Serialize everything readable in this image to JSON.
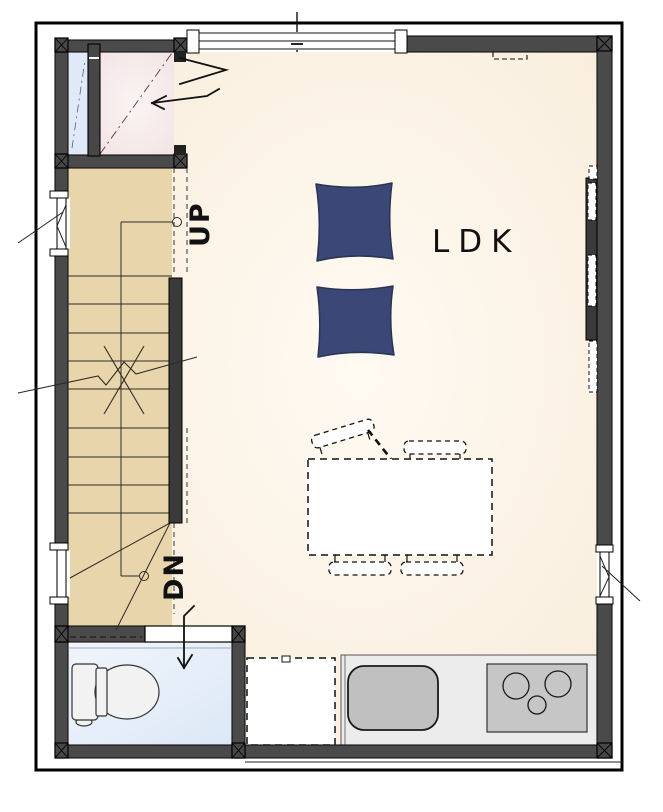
{
  "floor_plan": {
    "room_label": "LDK",
    "stairs": {
      "up_label": "UP",
      "dn_label": "DN"
    },
    "rooms": [
      {
        "name": "living-dining-kitchen",
        "label": "LDK",
        "floor_color": "#fbf1e1"
      },
      {
        "name": "staircase",
        "floor_color": "#e8d5ac"
      },
      {
        "name": "toilet",
        "floor_color": "#e7f0fa"
      },
      {
        "name": "entry-closet",
        "floor_color": "#f7e9ea"
      }
    ],
    "fixtures": {
      "floor_cushions": 2,
      "dining_chairs": 4,
      "dining_table": 1,
      "cooktop_burners": 3,
      "kitchen_sink": 1,
      "toilet": 1,
      "refrigerator_space": 1
    },
    "palette": {
      "wall": "#4a4a4a",
      "line": "#111111",
      "cushion": "#3a4777",
      "counter": "#ececec",
      "sink": "#c0c0c0",
      "cooktop": "#c6c6c6",
      "glass": "#dfe9f7",
      "stair_floor": "#e8d5ac"
    }
  }
}
